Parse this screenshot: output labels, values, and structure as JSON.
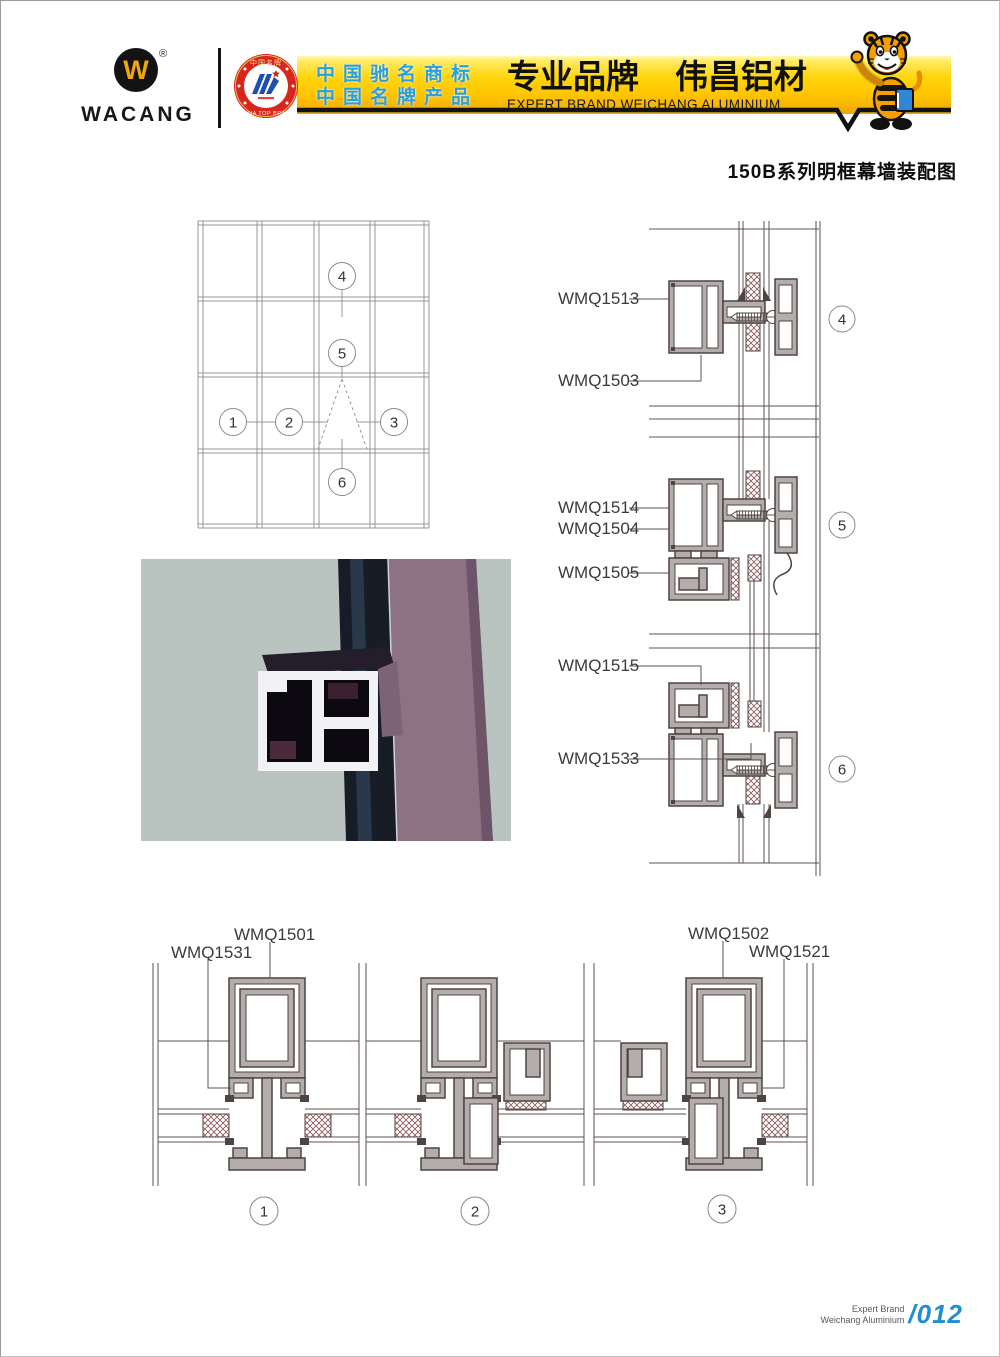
{
  "header": {
    "brand": "WACANG",
    "registered": "®",
    "logo_letter": "W",
    "badge_top": "中国名牌",
    "badge_bottom": "CHINA TOP BRAND",
    "banner_line1": "中国驰名商标",
    "banner_line2": "中国名牌产品",
    "brand_cn_a": "专业品牌",
    "brand_cn_b": "伟昌铝材",
    "brand_en": "EXPERT BRAND WEICHANG ALUMINIUM"
  },
  "title": "150B系列明框幕墙装配图",
  "elevation": {
    "callouts": [
      "1",
      "2",
      "3",
      "4",
      "5",
      "6"
    ]
  },
  "details_right": [
    {
      "callout": "4",
      "labels": [
        "WMQ1513",
        "WMQ1503"
      ]
    },
    {
      "callout": "5",
      "labels": [
        "WMQ1514",
        "WMQ1504",
        "WMQ1505"
      ]
    },
    {
      "callout": "6",
      "labels": [
        "WMQ1515",
        "WMQ1533"
      ]
    }
  ],
  "details_bottom": [
    {
      "callout": "1",
      "labels": [
        "WMQ1501",
        "WMQ1531"
      ]
    },
    {
      "callout": "2",
      "labels": []
    },
    {
      "callout": "3",
      "labels": [
        "WMQ1502",
        "WMQ1521"
      ]
    }
  ],
  "footer": {
    "line1": "Expert Brand",
    "line2": "Weichang Aluminium",
    "page": "/012"
  },
  "colors": {
    "banner_yellow": "#ffd40a",
    "banner_text_blue": "#2b9fdc",
    "badge_red": "#d8251d",
    "badge_emblem_blue": "#1e4fae",
    "logo_yellow": "#f2a60a",
    "page_number_blue": "#1f8ed2",
    "profile_fill": "#b5acac",
    "drawing_line": "#5c5252",
    "photo_background": "#b9c4c1",
    "photo_profile_purple": "#8d7284"
  }
}
